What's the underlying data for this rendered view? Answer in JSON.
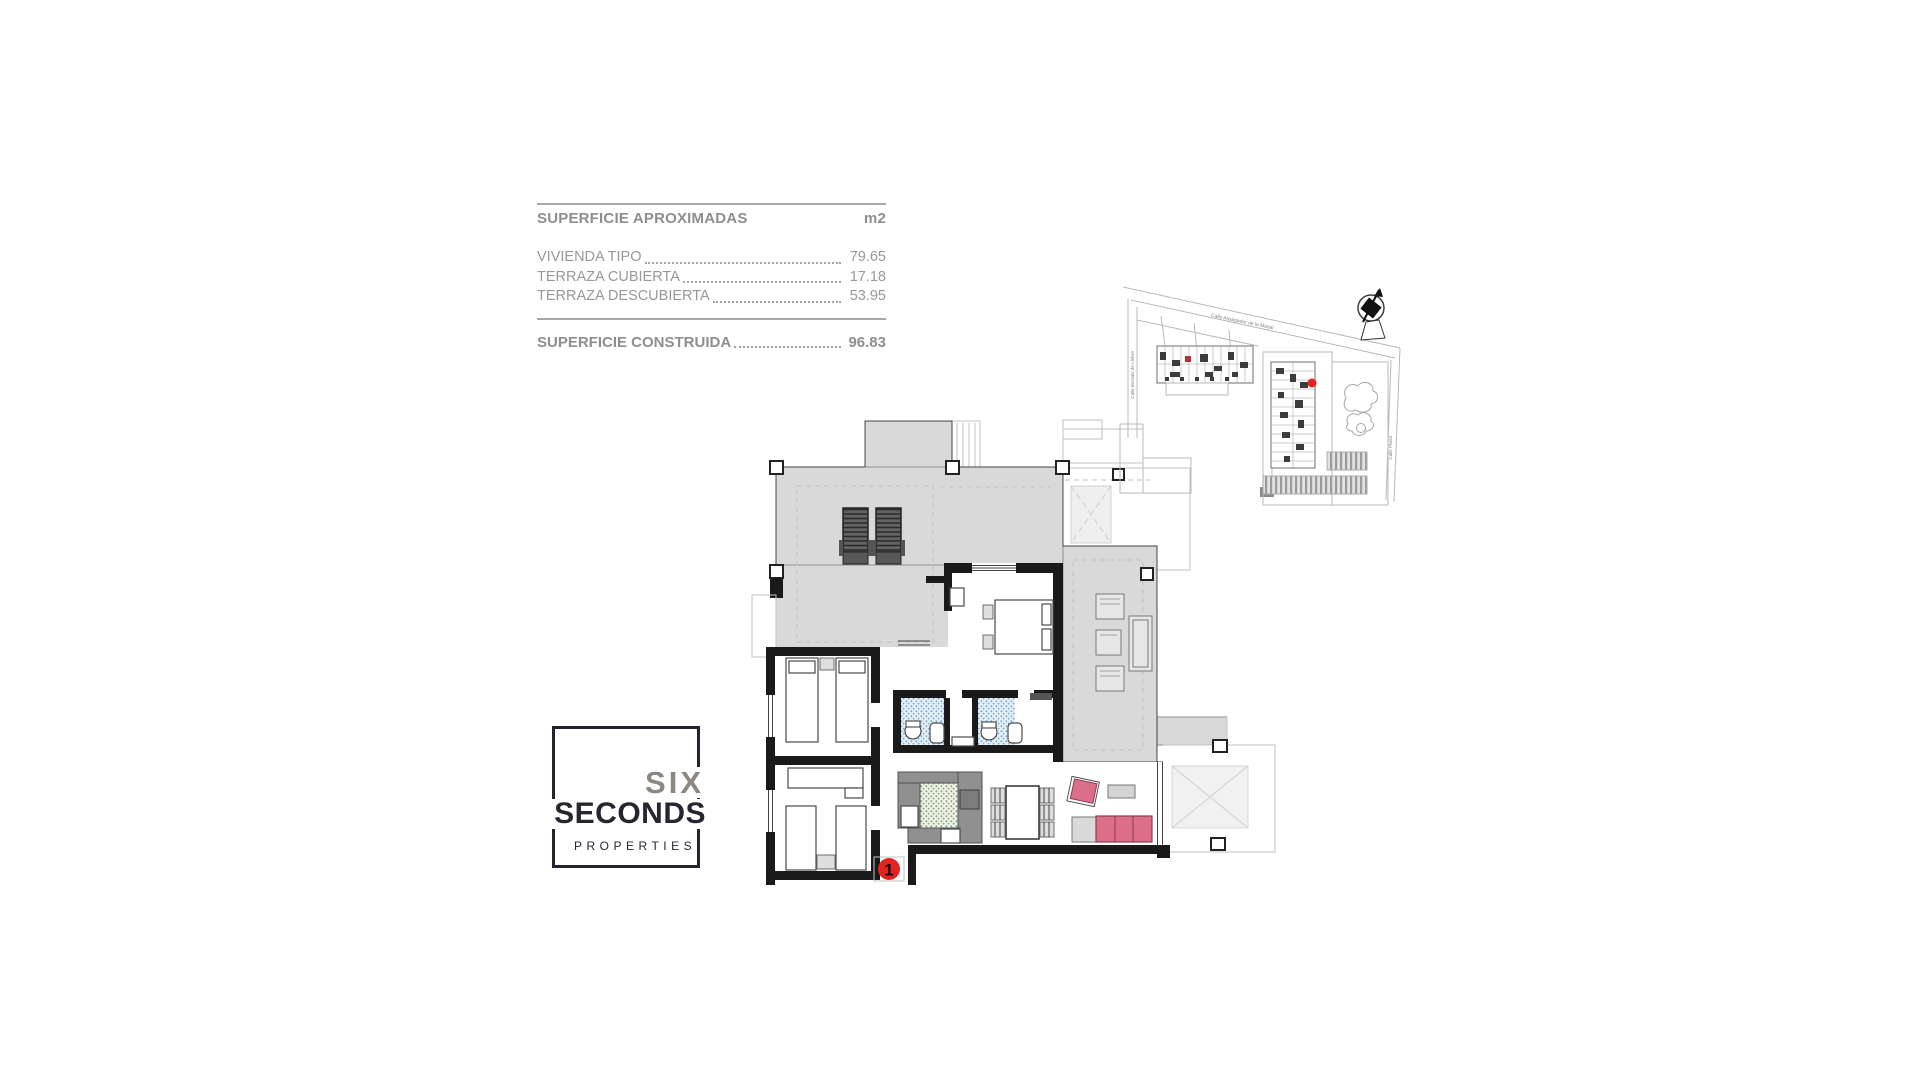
{
  "surface_table": {
    "title": "SUPERFICIE APROXIMADAS",
    "unit": "m2",
    "rows": [
      {
        "label": "VIVIENDA TIPO",
        "value": "79.65"
      },
      {
        "label": "TERRAZA CUBIERTA",
        "value": "17.18"
      },
      {
        "label": "TERRAZA DESCUBIERTA",
        "value": "53.95"
      }
    ],
    "total_label": "SUPERFICIE CONSTRUIDA",
    "total_value": "96.83"
  },
  "logo": {
    "word1": "SIX",
    "word2": "SECONDS",
    "word3": "PROPERTIES"
  },
  "floor_plan": {
    "unit_marker": "1",
    "colors": {
      "terrace_fill": "#d9d9d9",
      "bath_tile": "#79aad1",
      "kitchen_tile": "#8aa178",
      "sofa_pink": "#dd6e88",
      "marker_red": "#e42320",
      "counter_gray": "#909090"
    }
  },
  "site_map": {
    "street_top": "Calle Assagador de la Marjal",
    "street_left": "Calle Bordals de Llebre",
    "street_right": "Calle Plana"
  }
}
